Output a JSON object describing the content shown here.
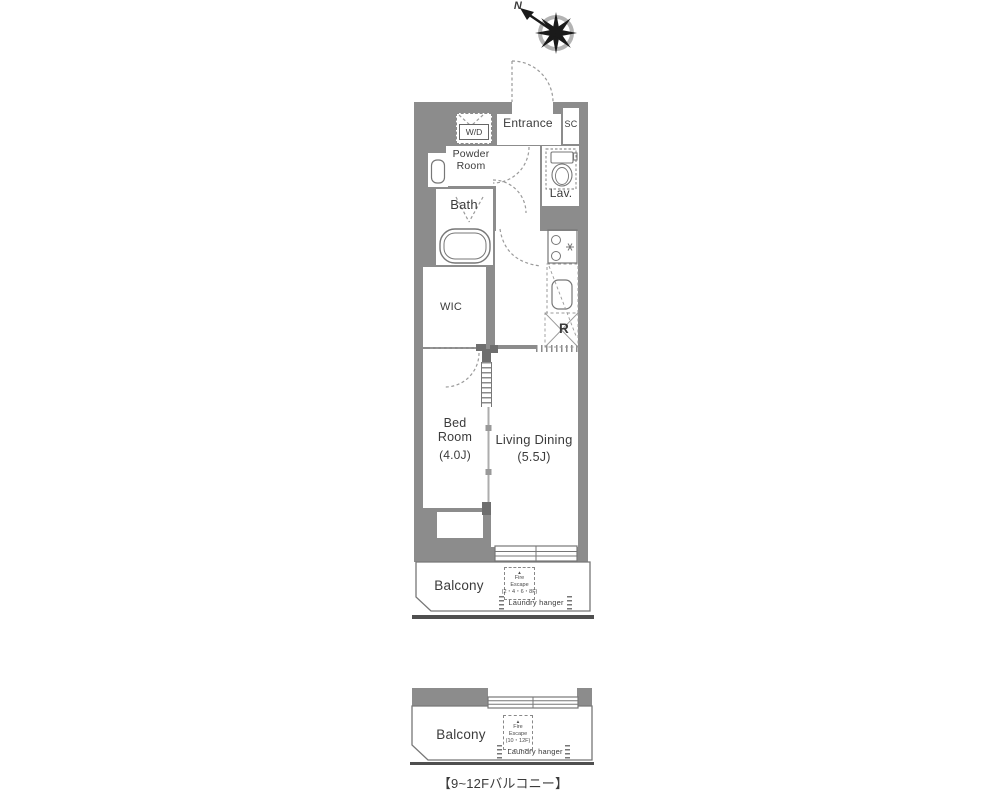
{
  "palette": {
    "wall": "#8c8c8c",
    "line": "#777777",
    "dash": "#999999",
    "dark": "#4f4f4f",
    "text": "#3b3b3b"
  },
  "compass": {
    "north_label": "N"
  },
  "unit_plan": {
    "entrance": "Entrance",
    "shoe_closet": "SC",
    "washer_dryer": "W/D",
    "powder_room": "Powder Room",
    "bath": "Bath",
    "lavatory": "Lav.",
    "walk_in_closet": "WIC",
    "bedroom": {
      "name": "Bed Room",
      "size": "(4.0J)"
    },
    "living_dining": {
      "name": "Living Dining",
      "size": "(5.5J)"
    },
    "refrigerator": "R"
  },
  "main_balcony": {
    "name": "Balcony",
    "fire_escape": {
      "marker": "▲",
      "line1": "Fire",
      "line2": "Escape",
      "line3": "(2・4・6・8F)"
    },
    "laundry_hanger": "Laundry hanger"
  },
  "upper_balcony": {
    "name": "Balcony",
    "fire_escape": {
      "marker": "▲",
      "line1": "Fire",
      "line2": "Escape",
      "line3": "(10・12F)"
    },
    "laundry_hanger": "Laundry hanger"
  },
  "caption": "【9~12Fバルコニー】",
  "icons": {
    "compass": "compass-rose-icon",
    "toilet": "toilet-icon",
    "bathtub": "bathtub-icon",
    "washbasin": "washbasin-icon",
    "stove": "stove-icon",
    "sink": "kitchen-sink-icon",
    "refrigerator_space": "refrigerator-space-icon",
    "door_arcs": "door-swing-arc",
    "windows": "window-glyph",
    "fire_escape_hatch": "fire-escape-hatch-icon",
    "laundry_marks": "laundry-hanger-marks"
  }
}
